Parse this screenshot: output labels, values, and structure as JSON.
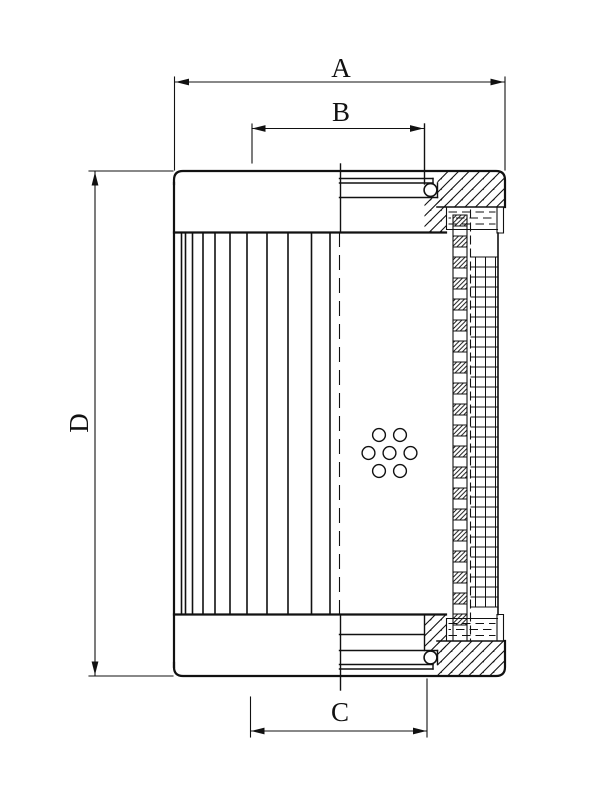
{
  "dimensions": {
    "a": {
      "label": "A"
    },
    "b": {
      "label": "B"
    },
    "c": {
      "label": "C"
    },
    "d": {
      "label": "D"
    }
  },
  "drawing": {
    "line_color": "#111111",
    "background": "#ffffff",
    "pleats": {
      "x_positions": [
        181.5,
        185.5,
        192.5,
        203,
        215,
        230,
        247,
        267,
        288,
        311.5,
        330
      ],
      "y_top": 232.5,
      "y_bottom": 614.5
    },
    "centerline": {
      "x": 339.5,
      "y_top": 232.5,
      "y_bottom": 614.5,
      "dash": "14 9"
    },
    "core_dashed_line": {
      "x": 470.5,
      "y_top": 210,
      "y_bottom": 640,
      "dash": "8 5"
    },
    "core_squares": {
      "x": 453,
      "width": 14,
      "y_start": 215,
      "y_end": 640,
      "cell_height": 11,
      "period": 21
    },
    "mesh": {
      "x_left": 471,
      "x_right": 497,
      "y_top": 257,
      "y_bottom": 607,
      "row_spacing": 10,
      "col_xs": [
        475.5,
        485.5,
        495.5
      ]
    },
    "seals": {
      "x_left": 449,
      "x_right": 495,
      "dash": "7.5 6",
      "top_rows_y": [
        212,
        218,
        224
      ],
      "bottom_rows_y": [
        623.5,
        629.5,
        635.5
      ]
    },
    "holes": {
      "radius": 6.4,
      "centers": [
        [
          379,
          435
        ],
        [
          400,
          435
        ],
        [
          368.5,
          453
        ],
        [
          389.5,
          453
        ],
        [
          410.5,
          453
        ],
        [
          379,
          471
        ],
        [
          400,
          471
        ]
      ]
    }
  }
}
